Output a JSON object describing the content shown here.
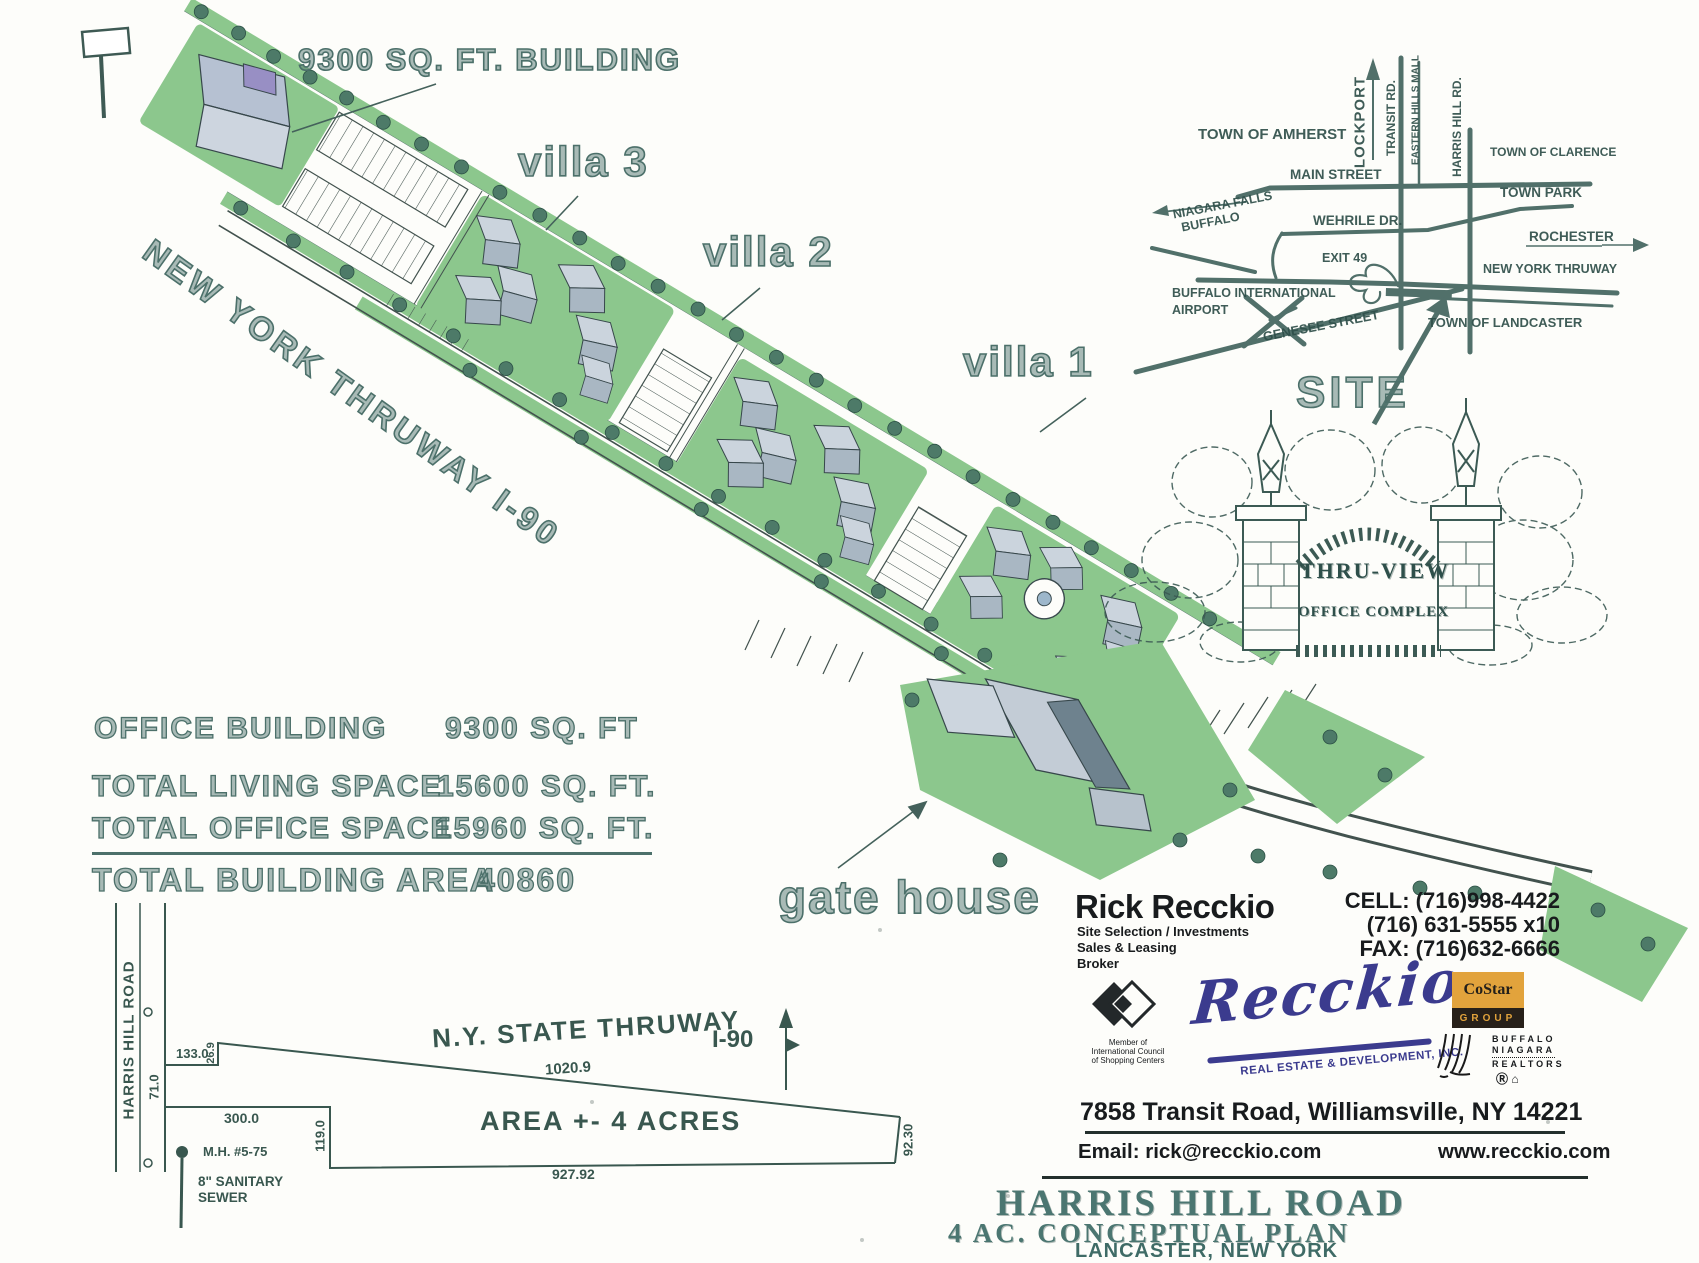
{
  "site_plan": {
    "building_label": "9300 SQ. FT. BUILDING",
    "villa3": "villa 3",
    "villa2": "villa 2",
    "villa1": "villa 1",
    "thruway_label": "NEW YORK THRUWAY I-90",
    "gate_house_label": "gate house"
  },
  "stats": {
    "rows": [
      {
        "label": "OFFICE BUILDING",
        "value": "9300 SQ. FT"
      },
      {
        "label": "TOTAL LIVING SPACE",
        "value": "15600 SQ. FT."
      },
      {
        "label": "TOTAL OFFICE SPACE",
        "value": "15960 SQ. FT."
      }
    ],
    "total_label": "TOTAL BUILDING AREA",
    "total_value": "40860"
  },
  "inset_map": {
    "town_amherst": "TOWN OF AMHERST",
    "lockport": "LOCKPORT",
    "transit_rd": "TRANSIT RD.",
    "eastern_hills": "EASTERN HILLS MALL",
    "harris_hill_rd": "HARRIS HILL RD.",
    "town_clarence": "TOWN OF CLARENCE",
    "main_street": "MAIN STREET",
    "town_park": "TOWN PARK",
    "niagara_falls": "NIAGARA FALLS",
    "buffalo": "BUFFALO",
    "wehrile_dr": "WEHRILE DR.",
    "rochester": "ROCHESTER",
    "exit_49": "EXIT 49",
    "new_york_thruway": "NEW YORK THRUWAY",
    "buffalo_international": "BUFFALO INTERNATIONAL",
    "airport": "AIRPORT",
    "genesee_street": "GENESEE STREET",
    "town_landcaster": "TOWN OF LANDCASTER",
    "site": "SITE"
  },
  "sign": {
    "line1": "THRU-VIEW",
    "line2": "OFFICE COMPLEX"
  },
  "survey": {
    "road": "HARRIS HILL ROAD",
    "thruway": "N.Y. STATE THRUWAY",
    "route": "I-90",
    "area": "AREA +- 4 ACRES",
    "dim_133": "133.0",
    "dim_269": "26.9",
    "dim_71": "71.0",
    "dim_300": "300.0",
    "dim_119": "119.0",
    "dim_1020": "1020.9",
    "dim_927": "927.92",
    "dim_9230": "92.30",
    "manhole": "M.H. #5-75",
    "sewer_line1": "8\" SANITARY",
    "sewer_line2": "SEWER"
  },
  "contact": {
    "name": "Rick Recckio",
    "role1": "Site Selection / Investments",
    "role2": "Sales & Leasing",
    "role3": "Broker",
    "cell": "CELL: (716)998-4422",
    "phone2": "(716) 631-5555 x10",
    "fax": "FAX: (716)632-6666",
    "icsc1": "Member of",
    "icsc2": "International Council",
    "icsc3": "of Shopping Centers",
    "logo_script": "Recckio",
    "logo_sub": "REAL ESTATE & DEVELOPMENT, INC.",
    "costar_top": "CoStar",
    "costar_bottom": "GROUP",
    "bn1": "BUFFALO",
    "bn2": "NIAGARA",
    "bn3": "REALTORS",
    "address": "7858 Transit Road, Williamsville, NY  14221",
    "email": "Email: rick@recckio.com",
    "website": "www.recckio.com"
  },
  "title_block": {
    "line1": "HARRIS HILL ROAD",
    "line2": "4 AC. CONCEPTUAL PLAN",
    "line3": "LANCASTER, NEW YORK"
  }
}
